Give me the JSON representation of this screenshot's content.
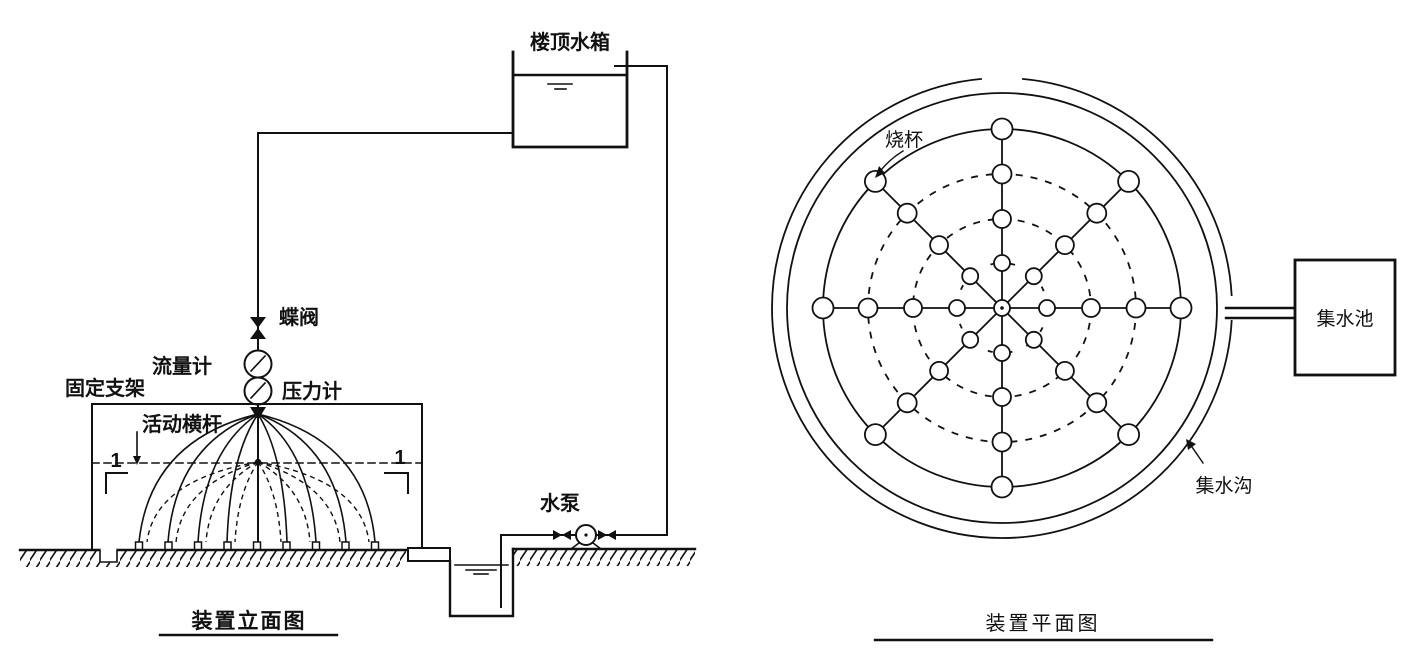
{
  "colors": {
    "ink": "#111111",
    "paper": "#ffffff"
  },
  "elevation": {
    "title": "装置立面图",
    "labels": {
      "tank": "楼顶水箱",
      "valve": "蝶阀",
      "flow_meter": "流量计",
      "pressure_gauge": "压力计",
      "frame": "固定支架",
      "crossbar": "活动横杆",
      "pump": "水泵",
      "section_left": "1",
      "section_right": "1"
    },
    "structure": {
      "nozzle_count": 9,
      "solid_spray_arcs": 8,
      "dashed_spray_arcs": 8
    }
  },
  "plan": {
    "title": "装置平面图",
    "labels": {
      "beaker": "烧杯",
      "pool": "集水池",
      "ditch": "集水沟"
    },
    "structure": {
      "arm_count": 8,
      "beaker_radii": [
        45,
        89,
        134,
        179
      ],
      "beaker_sizes": [
        8,
        9,
        9.5,
        10.5
      ],
      "dashed_ring_radii": [
        45,
        89,
        134
      ],
      "spray_ring_radius": 179,
      "beakers_per_arm": 4,
      "total_beakers": 32,
      "center_marker_radius": 8
    }
  }
}
